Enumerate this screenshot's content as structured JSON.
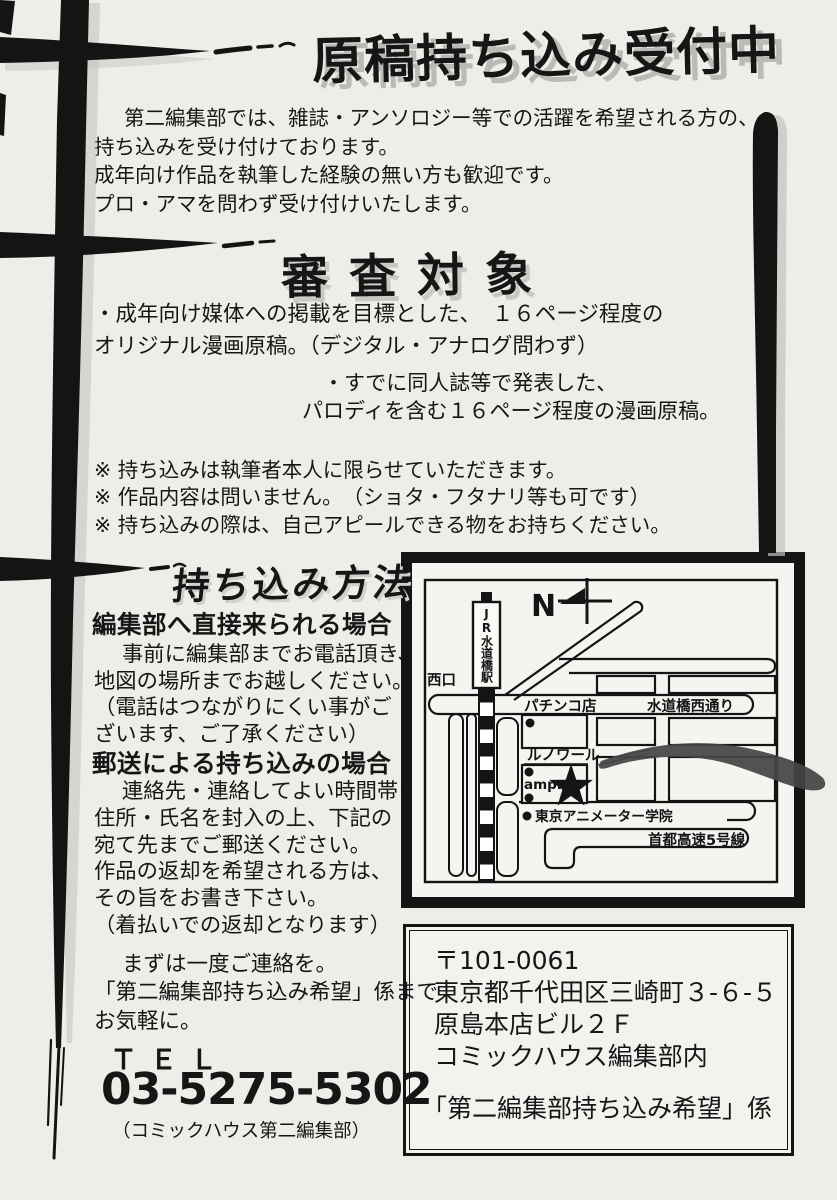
{
  "colors": {
    "paper": "#efede8",
    "ink": "#161616",
    "title_shadow": "#bcbab5",
    "arrow_gray": "#454545"
  },
  "page": {
    "title": "原稿持ち込み受付中",
    "intro": {
      "lines": [
        "第二編集部では、雑誌・アンソロジー等での活躍を希望される方の、",
        "持ち込みを受け付けております。",
        "成年向け作品を執筆した経験の無い方も歓迎です。",
        "プロ・アマを問わず受け付けいたします。"
      ]
    },
    "review": {
      "heading": "審査対象",
      "bullet1": [
        "・成年向け媒体への掲載を目標とした、　１６ページ程度の",
        "オリジナル漫画原稿。（デジタル・アナログ問わず）"
      ],
      "bullet2": [
        "・すでに同人誌等で発表した、",
        "パロディを含む１６ページ程度の漫画原稿。"
      ],
      "notes": [
        "※ 持ち込みは執筆者本人に限らせていただきます。",
        "※ 作品内容は問いません。　（ショタ・フタナリ等も可です）",
        "※ 持ち込みの際は、自己アピールできる物をお持ちください。"
      ]
    },
    "method": {
      "heading": "持ち込み方法",
      "visit": {
        "title": "編集部へ直接来られる場合",
        "lines": [
          "事前に編集部までお電話頂き、",
          "地図の場所までお越しください。",
          "（電話はつながりにくい事がご",
          "ざいます、ご了承ください）"
        ]
      },
      "mail": {
        "title": "郵送による持ち込みの場合",
        "lines": [
          "連絡先・連絡してよい時間帯・",
          "住所・氏名を封入の上、下記の",
          "宛て先までご郵送ください。",
          "作品の返却を希望される方は、",
          "その旨をお書き下さい。",
          "（着払いでの返却となります）"
        ]
      }
    },
    "contact": {
      "lines": [
        "まずは一度ご連絡を。",
        "「第二編集部持ち込み希望」係まで",
        "お気軽に。"
      ],
      "tel_label": "ＴＥＬ",
      "tel_number": "03-5275-5302",
      "tel_note": "（コミックハウス第二編集部）"
    },
    "map": {
      "north": "N",
      "station": "JR水道橋駅",
      "west_exit": "西口",
      "pachinko": "パチンコ店",
      "street": "水道橋西通り",
      "renoir": "ルノワール",
      "ampm": "ampm",
      "school": "東京アニメーター学院",
      "highway": "首都高速5号線"
    },
    "address": {
      "postal": "〒101-0061",
      "line1": "東京都千代田区三崎町３-６-５",
      "line2": "原島本店ビル２Ｆ",
      "line3": "コミックハウス編集部内",
      "recipient": "「第二編集部持ち込み希望」係"
    }
  }
}
